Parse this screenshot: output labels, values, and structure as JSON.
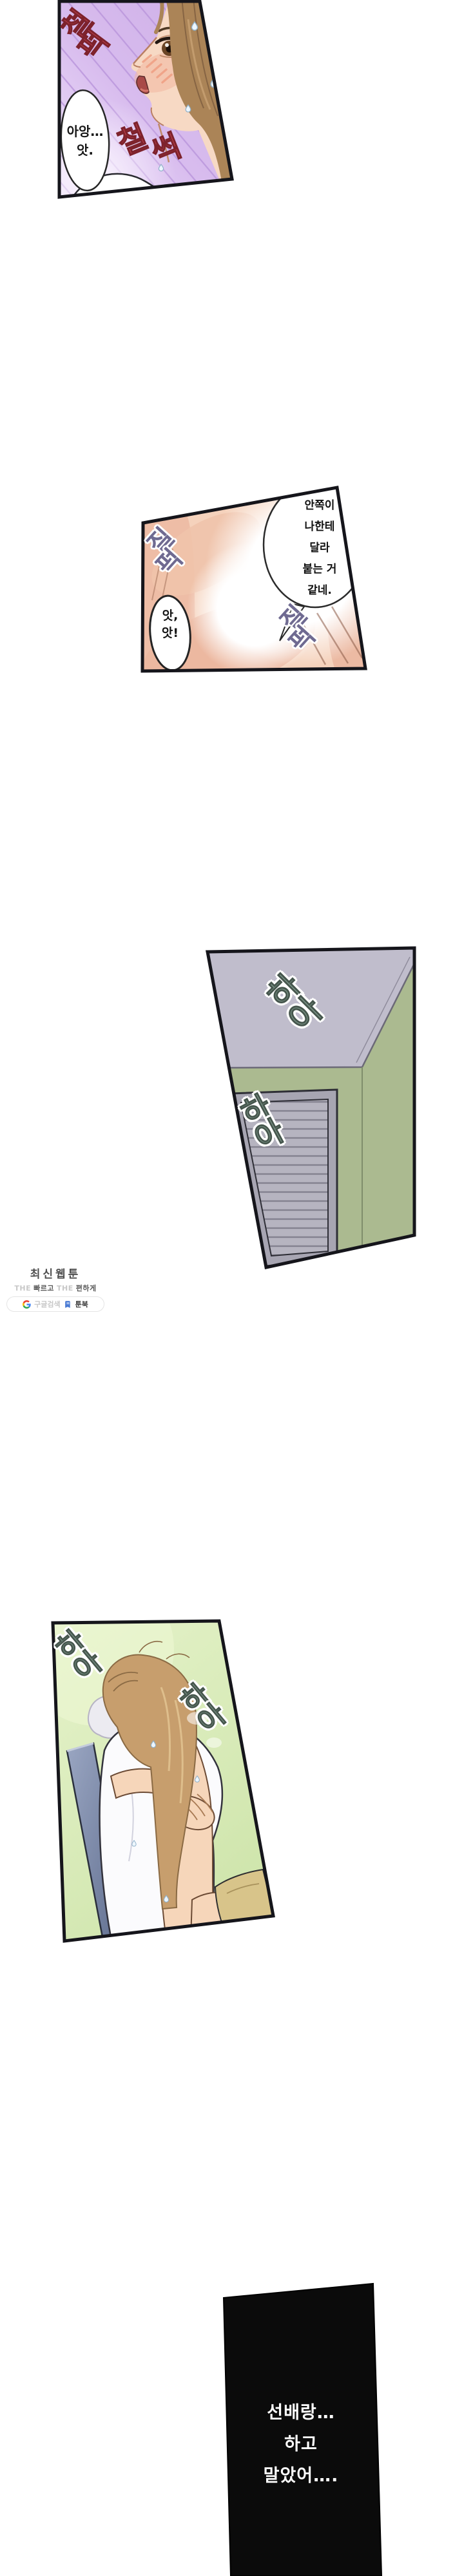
{
  "colors": {
    "page_bg": "#ffffff",
    "panel_border": "#15151b",
    "p1_bg": "#d2b5e9",
    "p1_stripe": "#ba96dc",
    "p1_sfx": "#c8454e",
    "p1_sfx_outline": "#7d222c",
    "p1_skin": "#f7d9c4",
    "p1_hair": "#ab8457",
    "p2_bg": "#f5d2bc",
    "p2_sfx": "#6f6a91",
    "p3_wall": "#abba90",
    "p3_ceiling": "#c0bdcc",
    "p3_door": "#b6b4c0",
    "p3_doorframe": "#a7a5b2",
    "p4_bg": "#cfe5ac",
    "p4_chair": "#7c89a8",
    "p4_pants": "#d8c48a",
    "p4_skin": "#f6d6ba",
    "p4_hair": "#c79e6d",
    "sfx_green": "#7e988b",
    "sfx_green_outline": "#46564d",
    "p5_bg": "#0b0b0b",
    "p5_text": "#ffffff",
    "wm_title": "#4f4f4f",
    "wm_light": "#c8c8c8",
    "wm_dark": "#585858",
    "wm_brand": "#3d3d3d",
    "wm_pill_border": "#e4e4e4",
    "wm_book": "#4a7bd4"
  },
  "panel1": {
    "sfx_top": {
      "chars": [
        "철",
        "퍽"
      ]
    },
    "sfx_corner": {
      "chars": [
        "퍽"
      ]
    },
    "sfx_slap": {
      "chars": [
        "철",
        "썩"
      ]
    },
    "bubble": {
      "lines": [
        "아앙…",
        "앗."
      ]
    }
  },
  "panel2": {
    "dialogue": {
      "lines": [
        "안쪽이",
        "나한테",
        "달라",
        "붙는 거",
        "같네."
      ]
    },
    "bubble": {
      "lines": [
        "앗,",
        "앗!"
      ]
    },
    "sfx_a": {
      "chars": [
        "질",
        "퍽"
      ]
    },
    "sfx_b": {
      "chars": [
        "질",
        "퍽"
      ]
    }
  },
  "panel3": {
    "sfx_a": {
      "chars": [
        "하",
        "아"
      ]
    },
    "sfx_b": {
      "chars": [
        "하",
        "아"
      ]
    }
  },
  "panel4": {
    "sfx_a": {
      "chars": [
        "하",
        "아"
      ]
    },
    "sfx_b": {
      "chars": [
        "하",
        "아"
      ]
    }
  },
  "panel5": {
    "monologue": {
      "lines": [
        "선배랑…",
        "하고",
        "말았어…."
      ]
    }
  },
  "watermark": {
    "title": "최신웹툰",
    "tagline": {
      "the1": "THE",
      "fast": "빠르고",
      "the2": "THE",
      "easy": "편하게"
    },
    "google_label": "구글검색",
    "brand": "툰북"
  }
}
